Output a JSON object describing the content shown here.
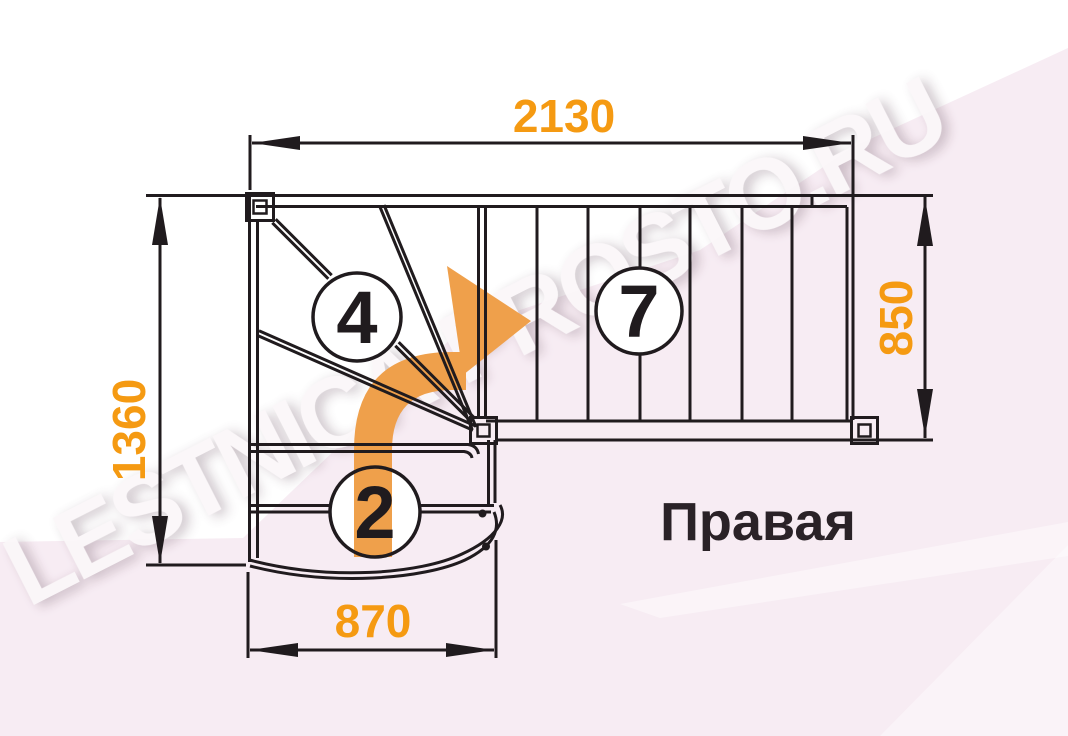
{
  "watermark": "LESTNICA-PROSTO.RU",
  "title": "Правая",
  "dimensions": {
    "top_width_mm": "2130",
    "left_depth_mm": "1360",
    "right_width_mm": "850",
    "bottom_width_mm": "870"
  },
  "step_markers": {
    "winder_steps": "4",
    "straight_flight_steps": "7",
    "lower_steps": "2"
  },
  "colors": {
    "dimension_text": "#F59A12",
    "direction_arrow": "#EFA04B",
    "drawing_line": "#201B1E",
    "watermark_pink": "#F7ECF3",
    "title_text": "#2A2227"
  }
}
